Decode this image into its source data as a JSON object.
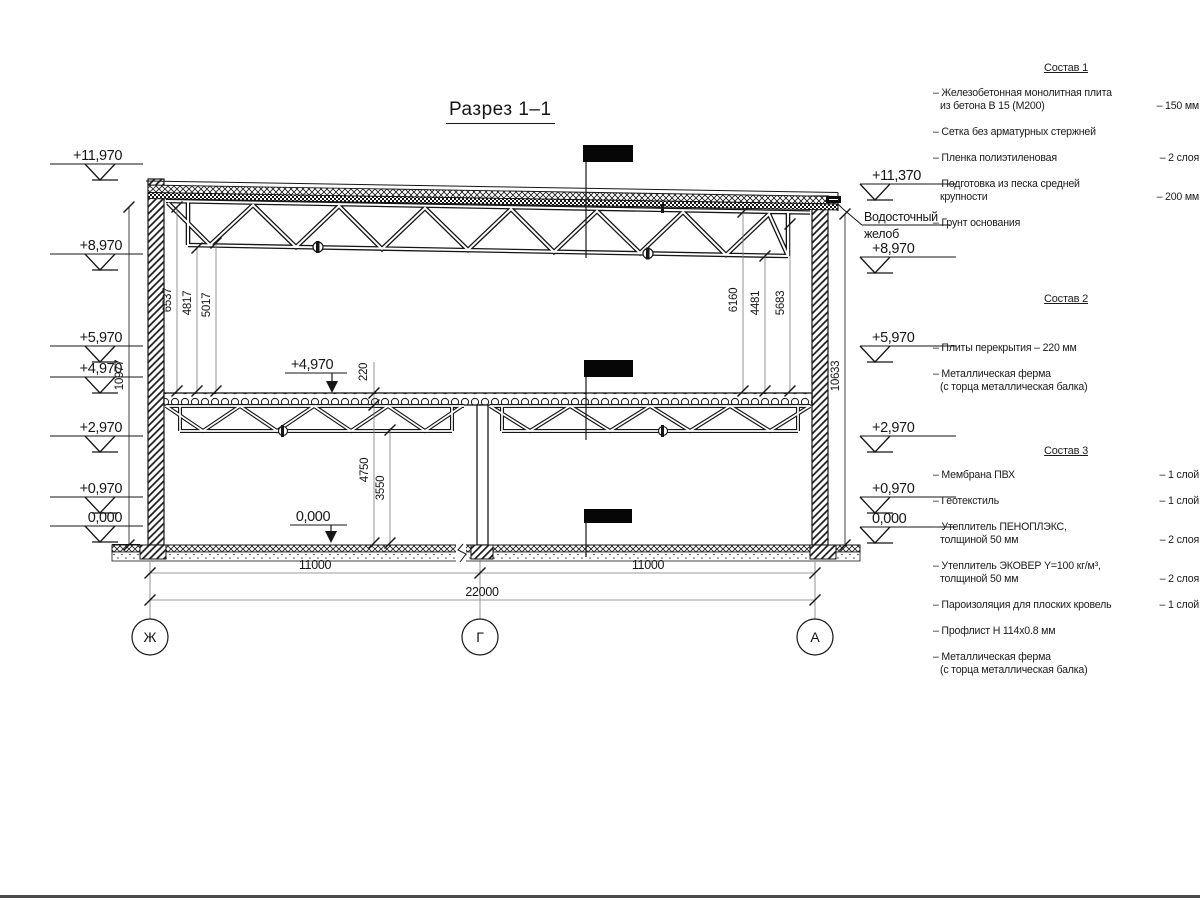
{
  "drawing": {
    "title": "Разрез 1–1",
    "elev_left": [
      "+11,970",
      "+8,970",
      "+5,970",
      "+4,970",
      "+2,970",
      "+0,970",
      "0,000"
    ],
    "elev_right": [
      "+11,370",
      "+8,970",
      "+5,970",
      "+2,970",
      "+0,970",
      "0,000"
    ],
    "gutter_note_line1": "Водосточный",
    "gutter_note_line2": "желоб",
    "mark_mid_floor": "+4,970",
    "mark_mid_zero": "0,000",
    "dim_wall_left": "10977",
    "dim_wall_right": "10633",
    "dims_int_left": [
      "6537",
      "4817",
      "5017"
    ],
    "dims_int_right": [
      "6160",
      "4481",
      "5683"
    ],
    "dim_slab": "220",
    "dim_h_under_slab": "4750",
    "dim_h_under_truss": "3550",
    "dim_span_left": "11000",
    "dim_span_right": "11000",
    "dim_span_total": "22000",
    "axes": [
      "Ж",
      "Г",
      "А"
    ]
  },
  "specs": [
    {
      "title": "Состав 1",
      "items": [
        {
          "line1": "– Железобетонная  монолитная плита",
          "line2": "из бетона В 15 (М200)",
          "value": "– 150 мм"
        },
        {
          "line1": "– Сетка без арматурных стержней",
          "line2": "",
          "value": ""
        },
        {
          "line1": "– Пленка полиэтиленовая",
          "line2": "",
          "value": "– 2 слоя"
        },
        {
          "line1": "– Подготовка из песка средней",
          "line2": "крупности",
          "value": "– 200 мм"
        },
        {
          "line1": "– Грунт основания",
          "line2": "",
          "value": ""
        }
      ]
    },
    {
      "title": "Состав 2",
      "items": [
        {
          "line1": "– Плиты перекрытия – 220 мм",
          "line2": "",
          "value": ""
        },
        {
          "line1": "– Металлическая ферма",
          "line2": "(с торца металлическая балка)",
          "value": ""
        }
      ]
    },
    {
      "title": "Состав 3",
      "items": [
        {
          "line1": "– Мембрана ПВХ",
          "line2": "",
          "value": "– 1 слой"
        },
        {
          "line1": "– Геотекстиль",
          "line2": "",
          "value": "– 1 слой"
        },
        {
          "line1": "– Утеплитель ПЕНОПЛЭКС,",
          "line2": "толщиной 50 мм",
          "value": "– 2 слоя"
        },
        {
          "line1": "– Утеплитель ЭКОВЕР Y=100 кг/м³,",
          "line2": "толщиной 50 мм",
          "value": "– 2 слоя"
        },
        {
          "line1": "– Пароизоляция для плоских кровель",
          "line2": "",
          "value": "– 1 слой"
        },
        {
          "line1": "– Профлист Н 114х0.8 мм",
          "line2": "",
          "value": ""
        },
        {
          "line1": "– Металлическая ферма",
          "line2": "(с торца металлическая балка)",
          "value": ""
        }
      ]
    }
  ]
}
